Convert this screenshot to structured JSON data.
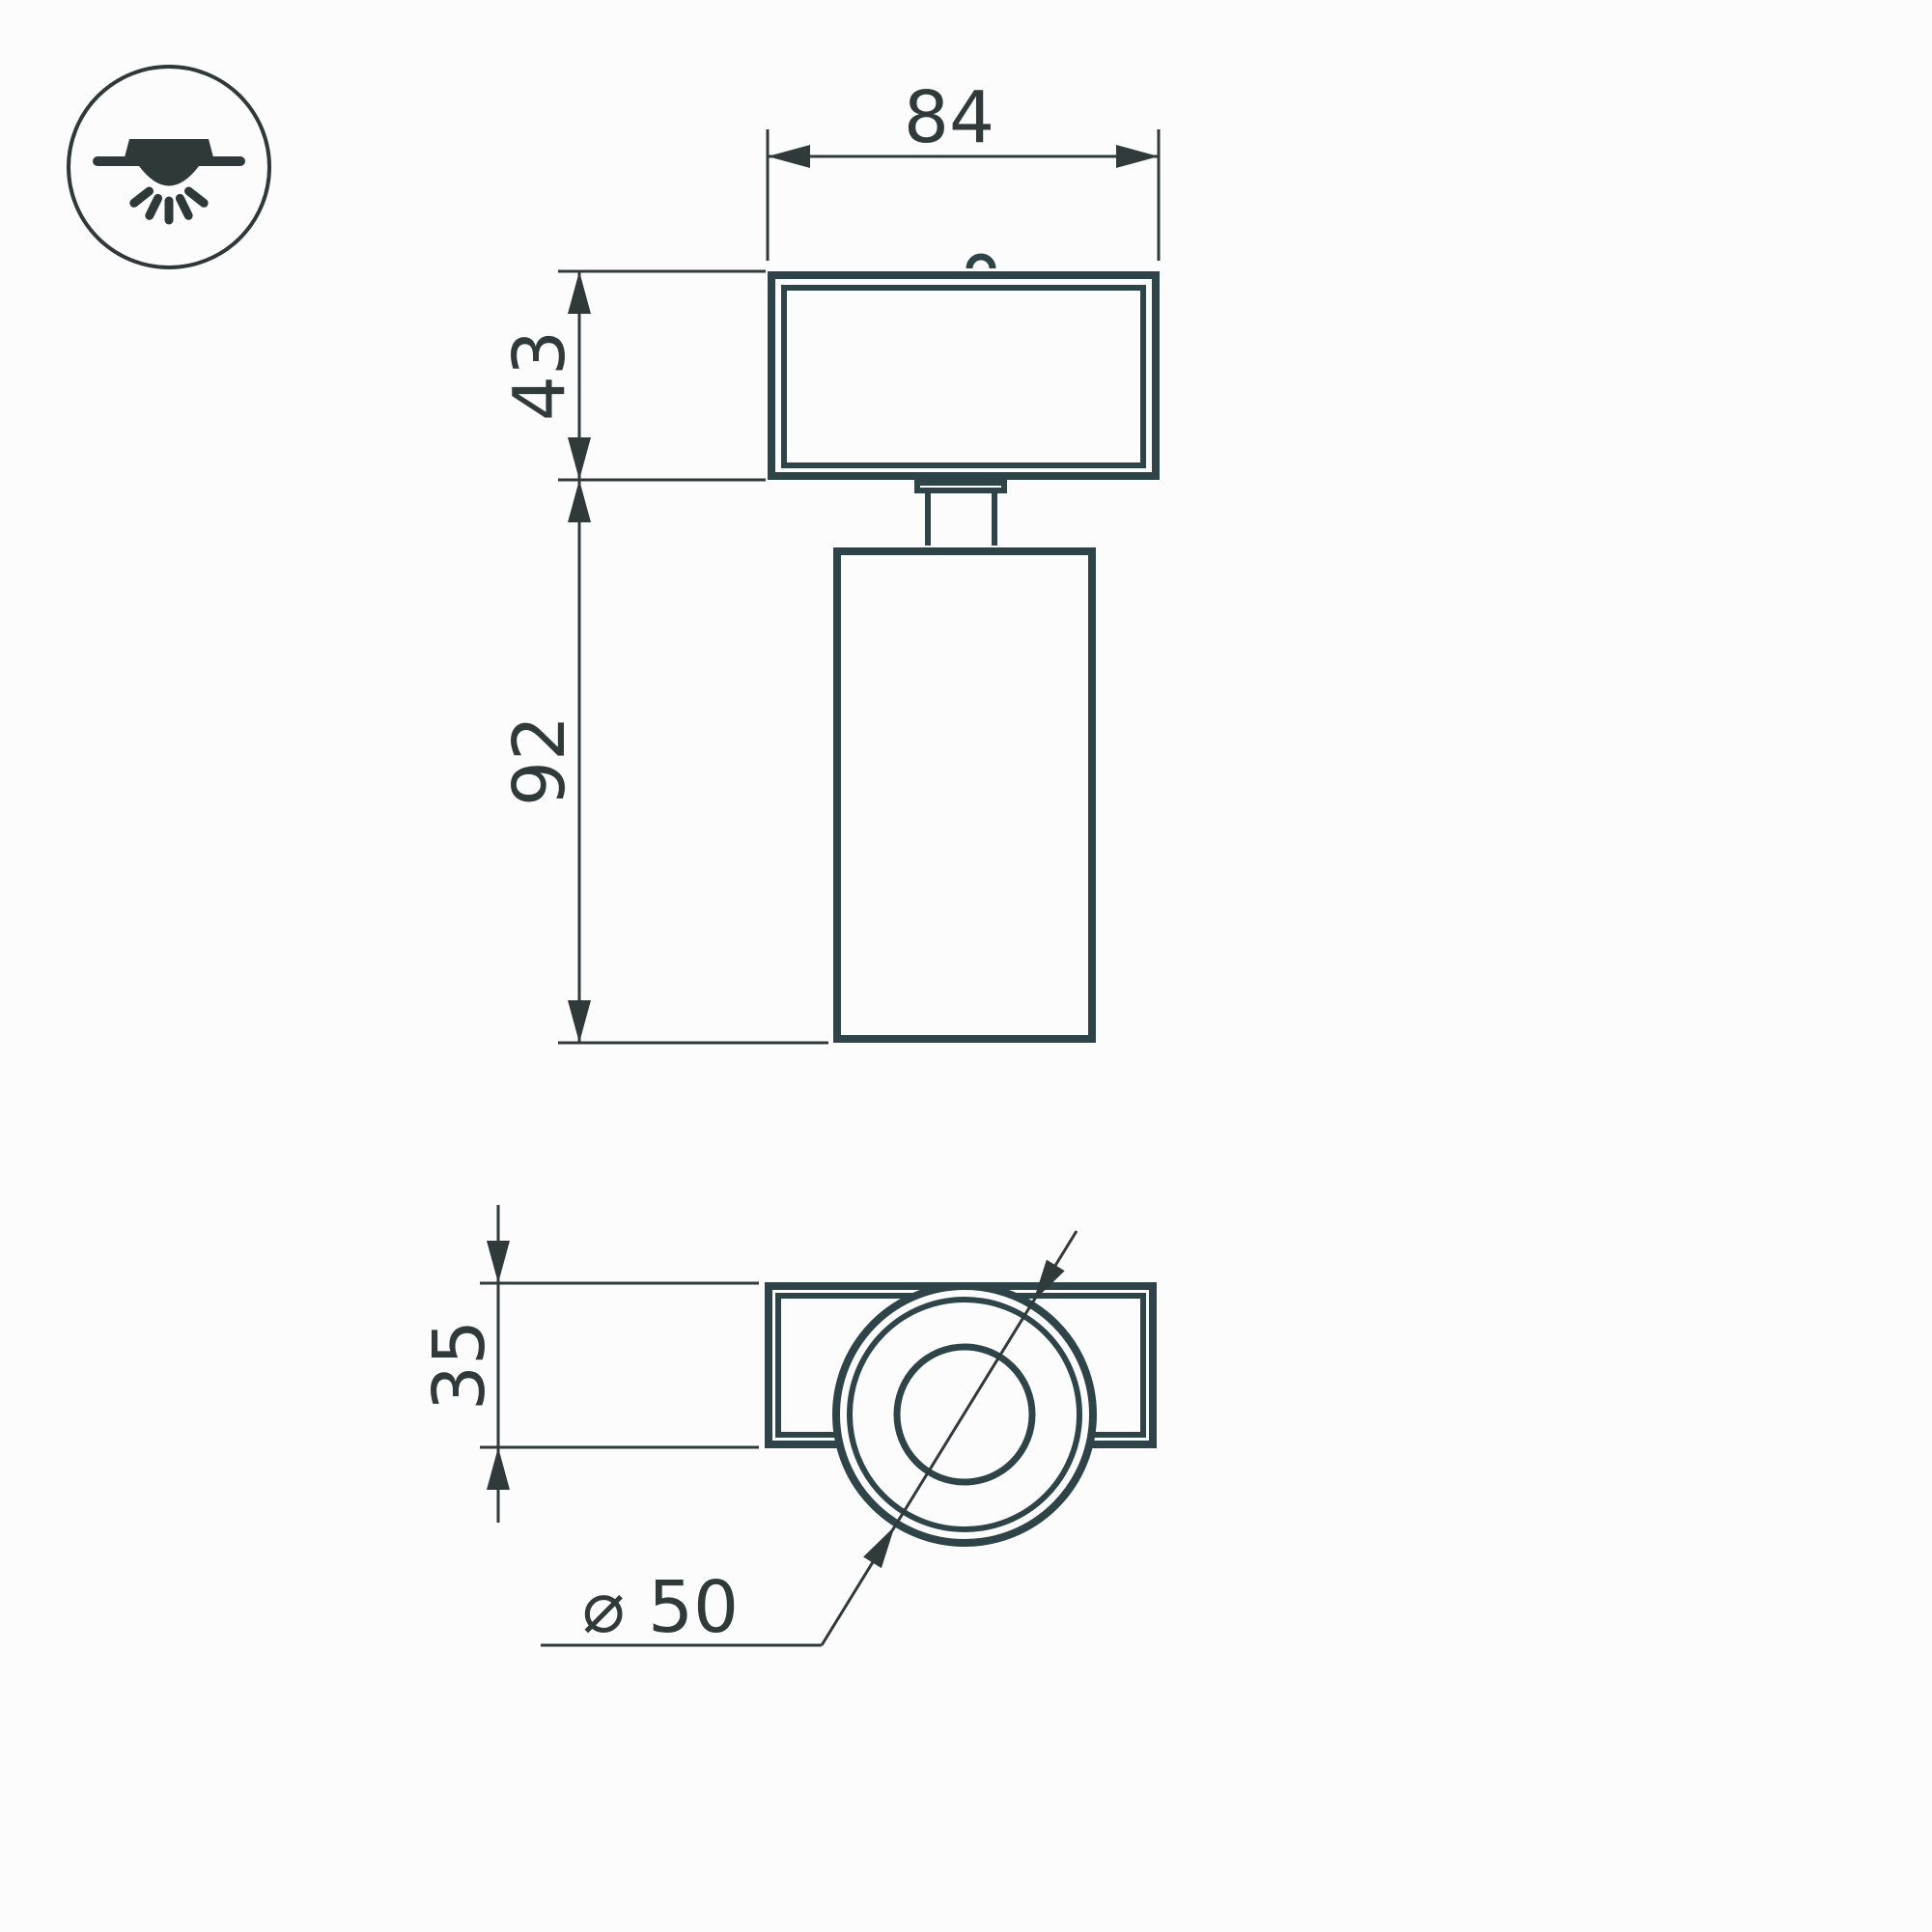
{
  "drawing": {
    "title": "spotlight-dimension-drawing",
    "background": "#fcfcfc",
    "outline_color": "#2f4448",
    "dimension_color": "#313a3b",
    "icon": {
      "name": "surface-mounted-downlight-icon",
      "color": "#2f393a"
    },
    "front_view": {
      "dim_width": {
        "label": "84",
        "value_mm": 84
      },
      "dim_head_height": {
        "label": "43",
        "value_mm": 43
      },
      "dim_body_height": {
        "label": "92",
        "value_mm": 92
      }
    },
    "bottom_view": {
      "dim_depth": {
        "label": "35",
        "value_mm": 35
      },
      "dim_diameter": {
        "label": "⌀ 50",
        "value_mm": 50
      }
    }
  }
}
